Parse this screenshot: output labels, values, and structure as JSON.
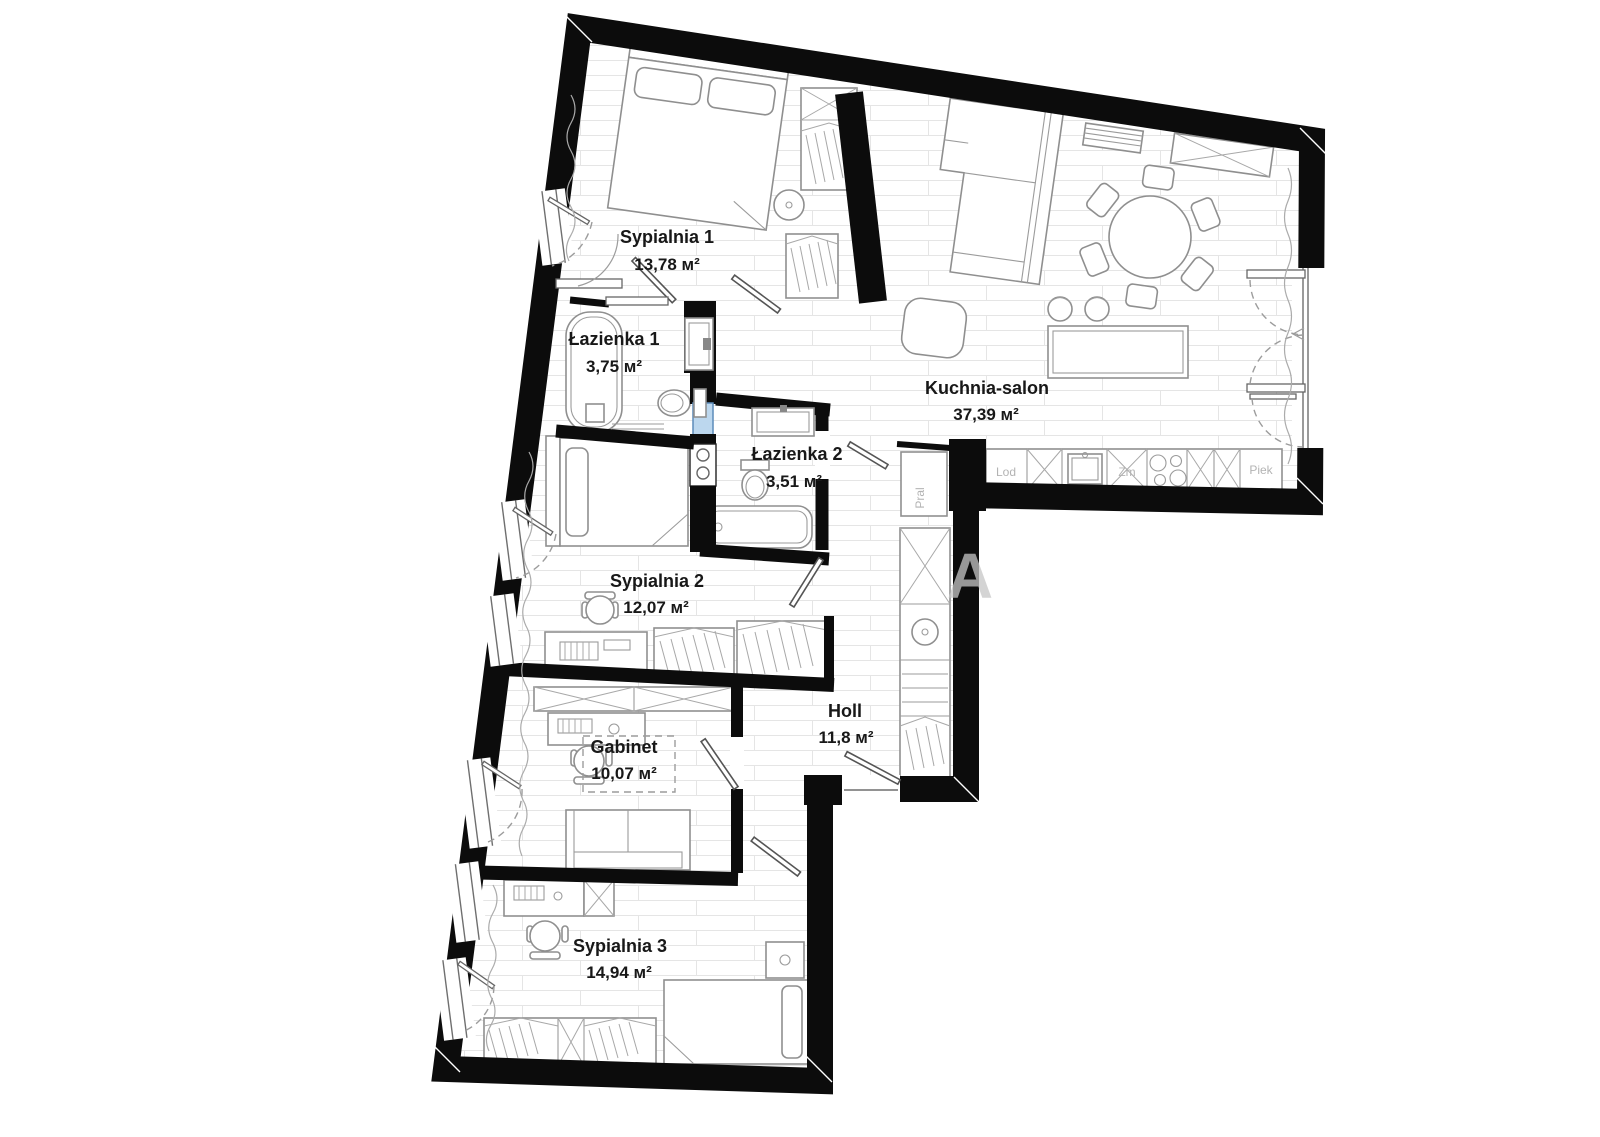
{
  "rooms": [
    {
      "name": "Sypialnia 1",
      "area": "13,78 м²"
    },
    {
      "name": "Łazienka 1",
      "area": "3,75 м²"
    },
    {
      "name": "Łazienka 2",
      "area": "3,51 м²"
    },
    {
      "name": "Kuchnia-salon",
      "area": "37,39 м²"
    },
    {
      "name": "Sypialnia 2",
      "area": "12,07 м²"
    },
    {
      "name": "Holl",
      "area": "11,8 м²"
    },
    {
      "name": "Gabinet",
      "area": "10,07 м²"
    },
    {
      "name": "Sypialnia 3",
      "area": "14,94 м²"
    }
  ],
  "appliances": {
    "washer": "Pral",
    "fridge": "Lod",
    "dishwasher": "Zm",
    "oven": "Piek"
  },
  "watermark": "A"
}
